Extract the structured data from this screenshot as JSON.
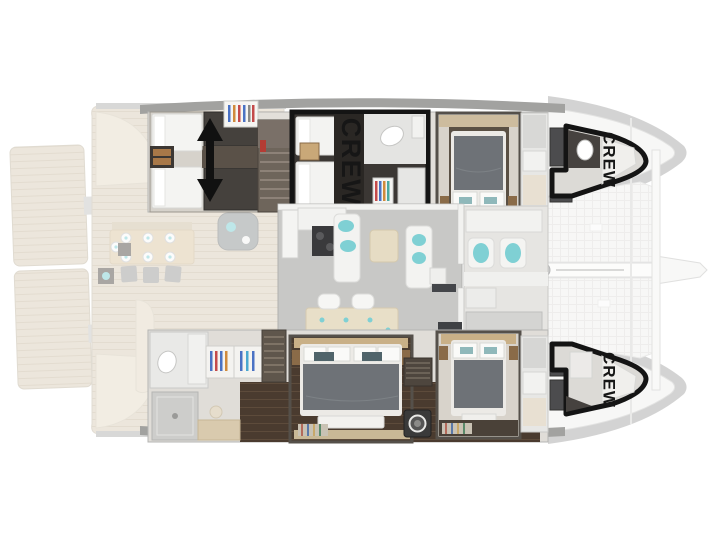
{
  "plan": {
    "type": "catamaran-interior-floorplan",
    "crew_areas": [
      {
        "id": "crew-cabin-midship",
        "label": "CREW"
      },
      {
        "id": "crew-bow-starboard",
        "label": "CREW"
      },
      {
        "id": "crew-bow-port",
        "label": "CREW"
      }
    ],
    "icons": {
      "bed_slide_arrow": "↕",
      "washing_machine": "◎",
      "toilet": "⬭",
      "mast_foot": "●"
    },
    "colors": {
      "background": "#ffffff",
      "hull_band": "#a9a9a9",
      "crew_outline": "#141414",
      "deck_wood": "#dbcfba",
      "dark_wood_floor": "#4a3b2f",
      "salon_floor": "#c8c8c6",
      "interior_wall": "#f2f2f0",
      "bed_duvet_gray": "#6e7277",
      "furniture_tan": "#c9b087",
      "accent_teal": "#7fd0d4",
      "dark_cabinet": "#45413d"
    }
  }
}
